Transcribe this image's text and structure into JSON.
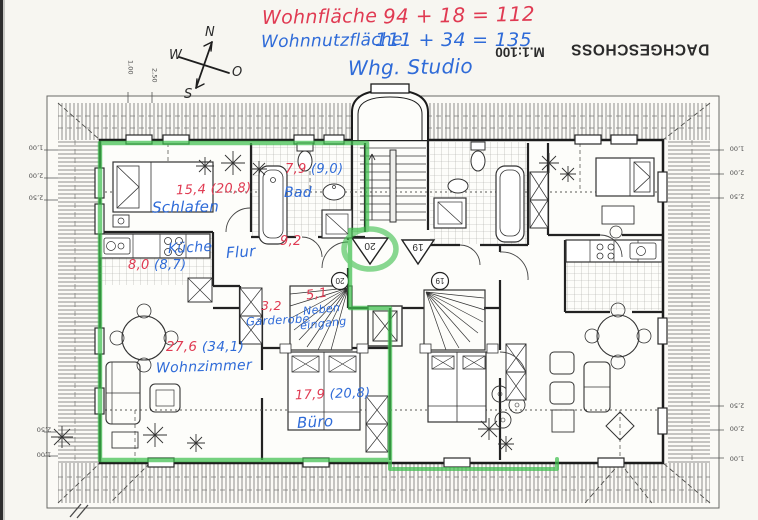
{
  "annotations": {
    "wohnflaeche": {
      "label": "Wohnfläche",
      "formula": "94 + 18 = 112"
    },
    "wohnnutzflaeche": {
      "label": "Wohnnutzfläche",
      "formula": "111 + 34 = 135"
    },
    "apartment_note": "Whg. Studio"
  },
  "title_block": {
    "drawing_title": "DACHGESCHOSS",
    "scale": "M.1:100"
  },
  "compass": {
    "north": "N",
    "east": "O",
    "south": "S",
    "west": "W"
  },
  "rooms": {
    "schlafen": {
      "label": "Schlafen",
      "area": "15,4 (20,8)"
    },
    "bad": {
      "label": "Bad",
      "area_red": "7,9",
      "area_blue": "(9,0)"
    },
    "flur": {
      "label": "Flur",
      "area_red": "9,2"
    },
    "kueche": {
      "label": "Küche",
      "area_red": "8,0",
      "area_blue": "(8,7)"
    },
    "garderobe": {
      "label": "Garderobe",
      "area_red": "3,2"
    },
    "nebeneingang": {
      "label_line1": "Neben",
      "label_line2": "eingang",
      "area_red": "5,1"
    },
    "wohnzimmer": {
      "label": "Wohnzimmer",
      "area_red": "27,6",
      "area_blue": "(34,1)"
    },
    "buero": {
      "label": "Büro",
      "area_red": "17,9",
      "area_blue": "(20,8)"
    }
  },
  "markers": {
    "left_unit_triangle": "20",
    "right_unit_triangle": "19",
    "left_unit_circle": "20",
    "right_unit_circle": "19"
  },
  "dims": {
    "top_left": [
      "1,00",
      "2,50"
    ],
    "left_top": [
      "1,00",
      "2,00",
      "2,50"
    ],
    "left_bottom": [
      "2,50",
      "1,00"
    ],
    "right_top": [
      "1,00",
      "2,00",
      "2,50"
    ],
    "right_bottom": [
      "2,50",
      "2,00",
      "1,00"
    ]
  },
  "colors": {
    "red": "#e03a52",
    "blue": "#2f6bd8",
    "green": "#3fbf4e",
    "ink": "#2b2b2b"
  }
}
